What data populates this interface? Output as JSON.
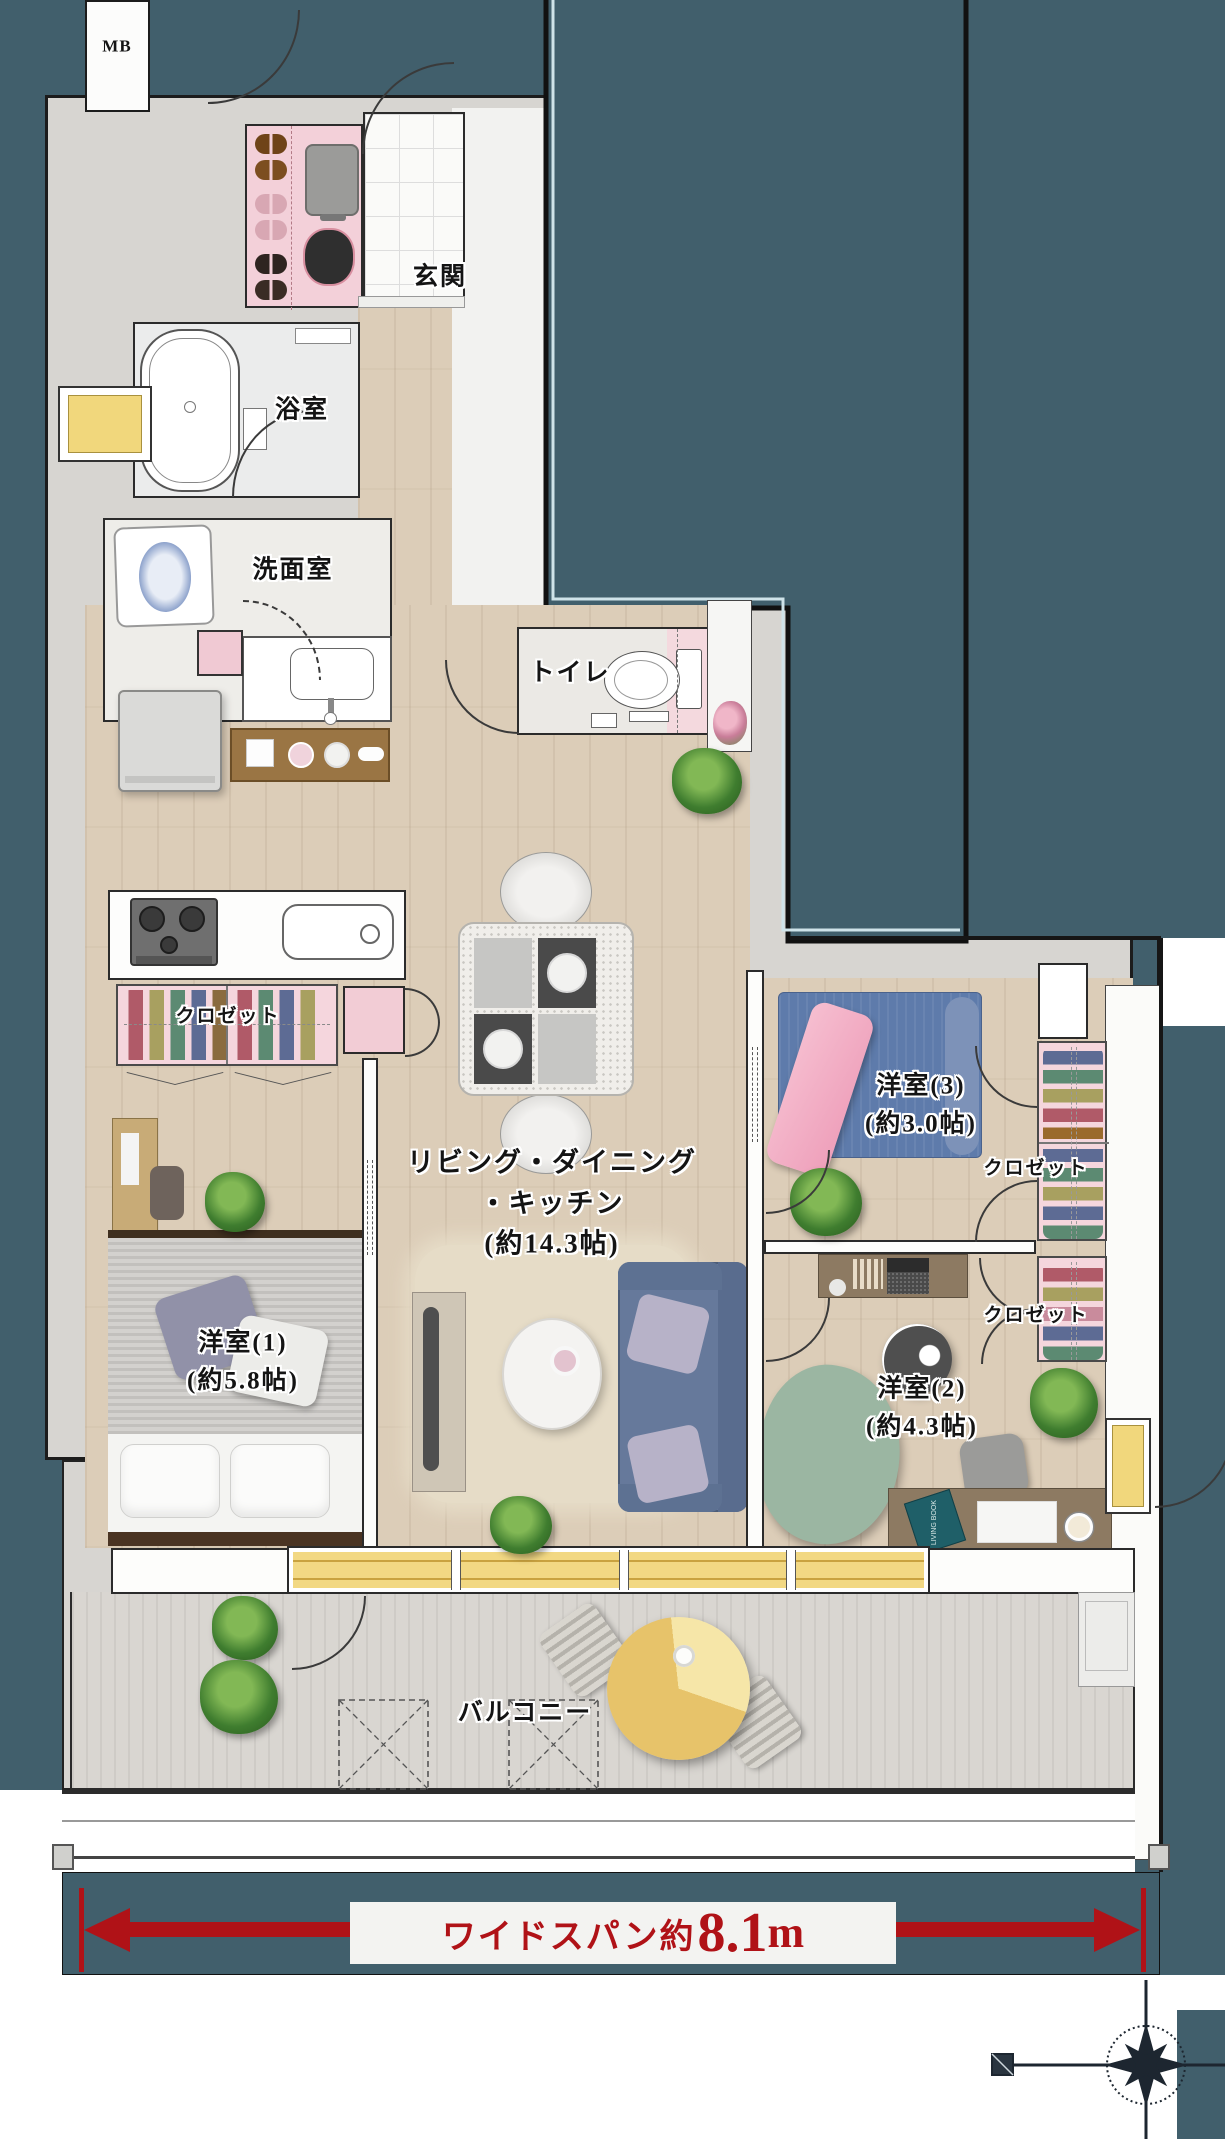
{
  "floor_plan": {
    "rooms": {
      "mb": {
        "label": "MB"
      },
      "entrance": {
        "label": "玄関"
      },
      "bathroom": {
        "label": "浴室"
      },
      "washroom": {
        "label": "洗面室"
      },
      "toilet": {
        "label": "トイレ"
      },
      "ldk": {
        "label_line1": "リビング・ダイニング",
        "label_line2": "・キッチン",
        "size": "(約14.3帖)"
      },
      "bedroom1": {
        "label": "洋室(1)",
        "size": "(約5.8帖)"
      },
      "bedroom2": {
        "label": "洋室(2)",
        "size": "(約4.3帖)"
      },
      "bedroom3": {
        "label": "洋室(3)",
        "size": "(約3.0帖)"
      },
      "balcony": {
        "label": "バルコニー"
      },
      "closet_bedroom1": {
        "label": "クロゼット"
      },
      "closet_bedroom3": {
        "label": "クロゼット"
      },
      "closet_bedroom2": {
        "label": "クロゼット"
      }
    },
    "dimension": {
      "prefix": "ワイドスパン約",
      "value": "8.1",
      "unit": "m"
    },
    "furniture": {
      "book_title": "LIVING BOOK"
    },
    "colors": {
      "background_teal": "#415F6C",
      "wall_gray": "#D8D6D2",
      "wood_floor": "#DCCDB8",
      "closet_pink": "#F4D4DC",
      "window_yellow": "#F0D77E",
      "dimension_red": "#B01217"
    }
  }
}
